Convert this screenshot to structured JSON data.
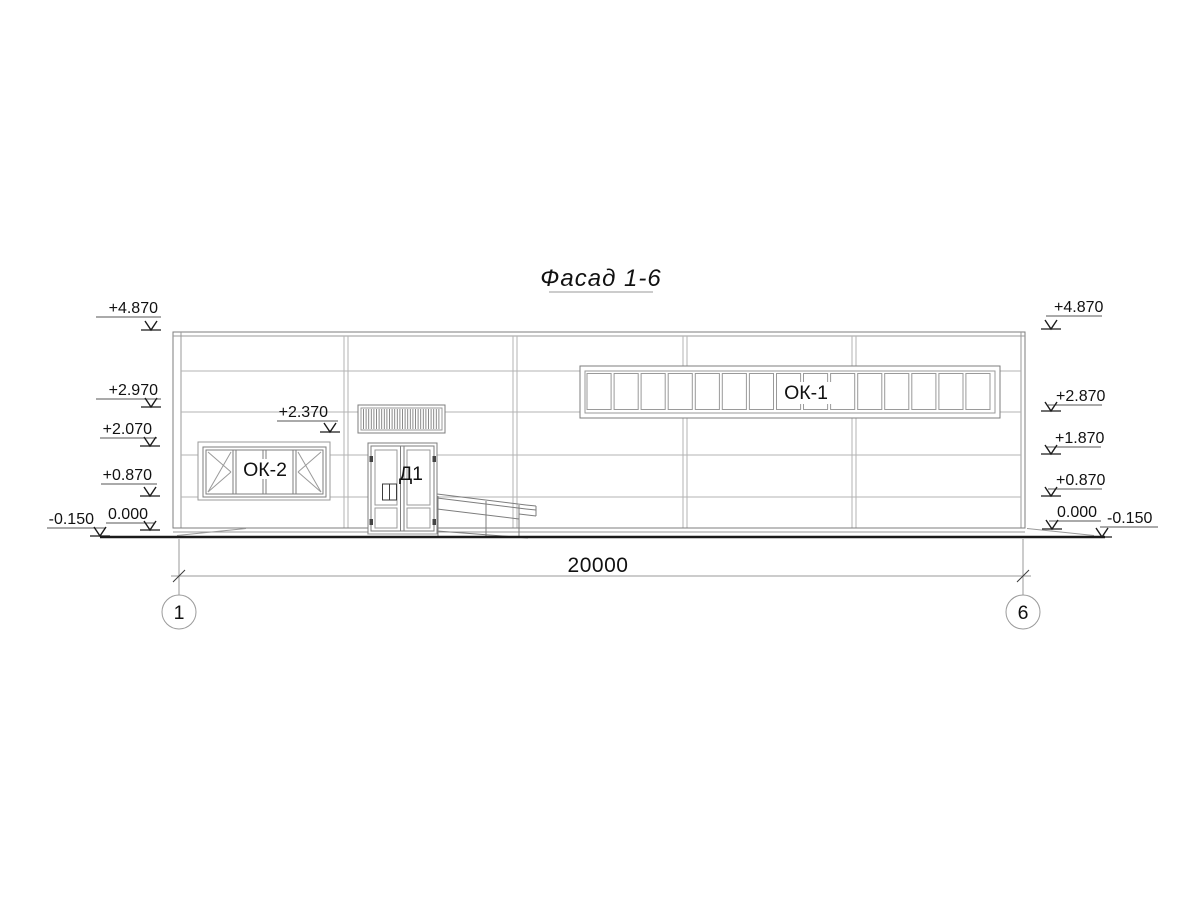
{
  "title": "Фасад 1-6",
  "labels": {
    "window_strip": "ОК-1",
    "window_left": "ОК-2",
    "door": "Д1"
  },
  "windows": {
    "strip_pane_count": 15,
    "left_pane_count": 4
  },
  "dimension": {
    "total_width": "20000"
  },
  "axes": {
    "left": "1",
    "right": "6"
  },
  "elevations": {
    "left": [
      "+4.870",
      "+2.970",
      "+2.070",
      "+0.870",
      "0.000",
      "-0.150"
    ],
    "right": [
      "+4.870",
      "+2.870",
      "+1.870",
      "+0.870",
      "0.000",
      "-0.150"
    ],
    "door_canopy": "+2.370"
  },
  "colors": {
    "line_thin": "#9a9a9a",
    "line_dark": "#3c3c3c",
    "ground": "#1a1a1a",
    "text": "#111111"
  }
}
